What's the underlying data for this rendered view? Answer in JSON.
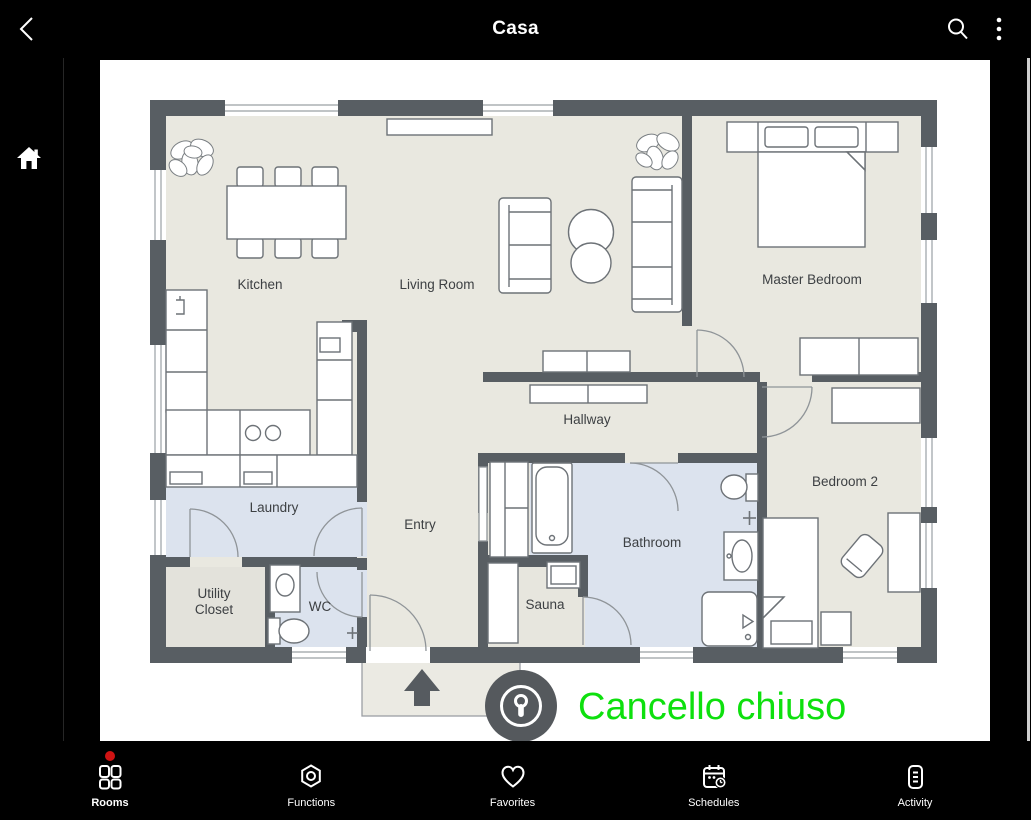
{
  "app": {
    "title": "Casa"
  },
  "topbar": {
    "back_icon": "back-chevron-icon",
    "search_icon": "search-icon",
    "menu_icon": "overflow-menu-icon"
  },
  "sidebar": {
    "home_icon": "home-icon"
  },
  "plan": {
    "labels": {
      "kitchen": "Kitchen",
      "living_room": "Living Room",
      "master_bedroom": "Master Bedroom",
      "hallway": "Hallway",
      "laundry": "Laundry",
      "entry": "Entry",
      "bathroom": "Bathroom",
      "bedroom2": "Bedroom 2",
      "sauna": "Sauna",
      "wc": "WC",
      "utility_line1": "Utility",
      "utility_line2": "Closet"
    },
    "colors": {
      "wall": "#585e63",
      "floor": "#e9e8e0",
      "wet_floor": "#dce3ee",
      "utility_floor": "#e3e2db",
      "porch": "#ebeae3"
    }
  },
  "status": {
    "message": "Cancello chiuso",
    "color": "#0ee00e",
    "icon": "keyhole-lock-icon"
  },
  "bottom_nav": {
    "badge_color": "#cf1313",
    "items": [
      {
        "label": "Rooms",
        "icon": "rooms-grid-icon",
        "active": true,
        "badge": true
      },
      {
        "label": "Functions",
        "icon": "functions-hexagon-icon",
        "active": false,
        "badge": false
      },
      {
        "label": "Favorites",
        "icon": "favorites-heart-icon",
        "active": false,
        "badge": false
      },
      {
        "label": "Schedules",
        "icon": "schedules-calendar-icon",
        "active": false,
        "badge": false
      },
      {
        "label": "Activity",
        "icon": "activity-log-icon",
        "active": false,
        "badge": false
      }
    ]
  }
}
